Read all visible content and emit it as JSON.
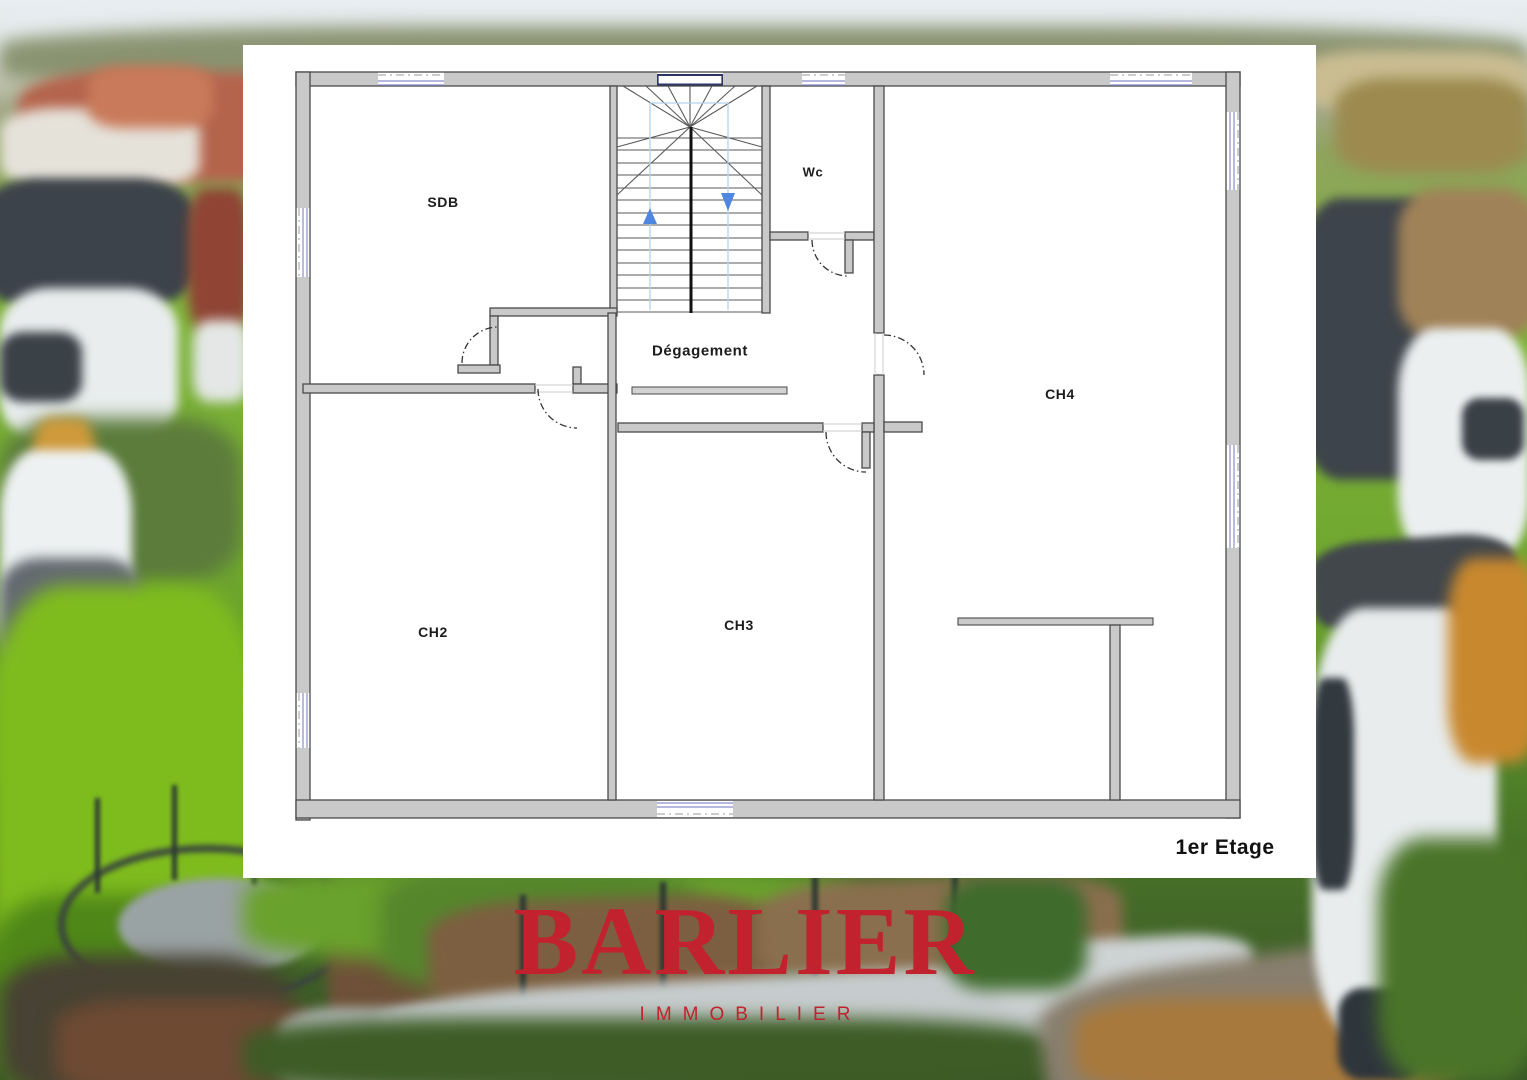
{
  "floor_plan": {
    "floor_label": "1er Etage",
    "rooms": [
      {
        "id": "sdb",
        "label": "SDB"
      },
      {
        "id": "wc",
        "label": "Wc"
      },
      {
        "id": "degagement",
        "label": "Dégagement"
      },
      {
        "id": "ch2",
        "label": "CH2"
      },
      {
        "id": "ch3",
        "label": "CH3"
      },
      {
        "id": "ch4",
        "label": "CH4"
      }
    ],
    "stairs": {
      "up_arrow_icon": "stairs-up-arrow",
      "down_arrow_icon": "stairs-down-arrow"
    },
    "colors": {
      "wall_fill": "#c9c9c9",
      "wall_stroke": "#4a4a4a",
      "window_blue": "#8a8ccc",
      "stair_window_dark": "#2e3566",
      "stair_guide_blue": "#b5d2ec",
      "arrow_blue": "#4f86e0",
      "label_text": "#1c1c1c",
      "panel_background": "#ffffff"
    }
  },
  "logo": {
    "name": "BARLIER",
    "subtitle": "IMMOBILIER",
    "color": "#c1222d"
  }
}
